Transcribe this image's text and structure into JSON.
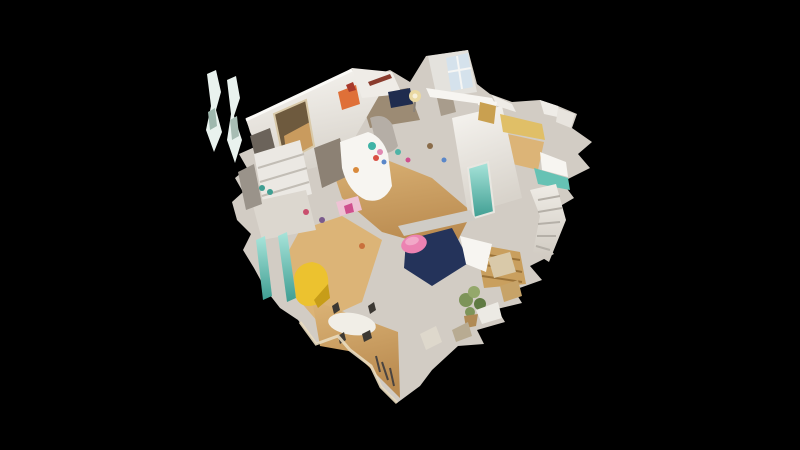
{
  "viewer": {
    "background_color": "#000000",
    "view_mode": "dollhouse",
    "content": "Textless 3D cutaway dollhouse view of a scanned apartment floating on a black void; no UI chrome visible"
  },
  "palette": {
    "background": "#000000",
    "wall_white": "#efece7",
    "wall_bright": "#f7f5f1",
    "wall_mid": "#d2ccc4",
    "wall_grey": "#b5aea6",
    "room_floor_shadow": "#9c8b74",
    "doorway_shadow": "#8c8174",
    "floor_wood": "#d3a768",
    "floor_wood_light": "#dcb477",
    "floor_pale_edge": "#e9dcc0",
    "bedroom_wall_yellow": "#e0bf67",
    "gold_wardrobe": "#c9a050",
    "bed_navy": "#24335a",
    "tv_navy": "#1f2c4e",
    "pillow_pink": "#ec82b2",
    "bench_pink": "#eec2d4",
    "armchair_yellow": "#ecc22f",
    "armchair_shadow": "#c79d18",
    "glass_teal": "#66c2b4",
    "teal_deep": "#3f9e92",
    "accent_orange": "#df7038",
    "accent_red": "#a8392b",
    "plant_green": "#7d9459",
    "stair_wood": "#c99f5e",
    "window_glow": "#d5e2ec",
    "mirror_warm": "#6e5a3e",
    "mirror_glow": "#c99b5e",
    "appliance_grey": "#9a938a",
    "kitchen_shelf_dark": "#6b635a",
    "table_white": "#f1eee7",
    "chair_dark": "#3c3833",
    "artifact_white": "#e9f2ee"
  }
}
